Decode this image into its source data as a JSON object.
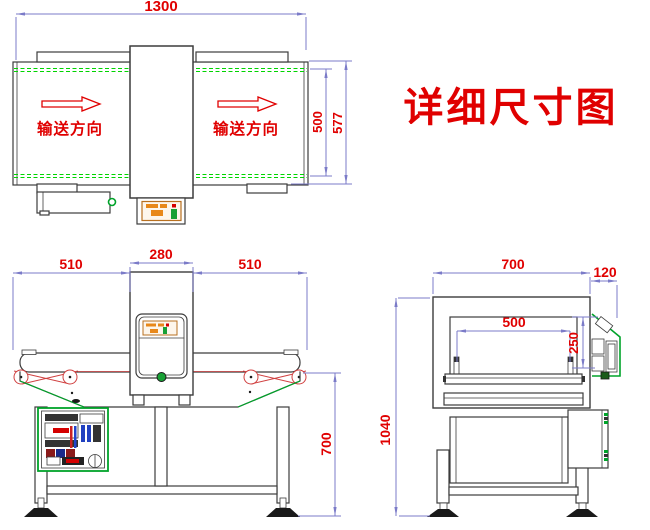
{
  "title": "详细尺寸图",
  "colors": {
    "dimension_line": "#7b7bc8",
    "dimension_text": "#e00000",
    "drawing_line": "#3c3c3c",
    "machine_green": "#00a32a",
    "belt_guide_green": "#00d400",
    "display_orange": "#e8881a"
  },
  "top_view": {
    "flow_label_left": "输送方向",
    "flow_label_right": "输送方向",
    "dim_overall_length": "1300",
    "dim_belt_width": "500",
    "dim_overall_width": "577"
  },
  "front_view": {
    "dim_infeed": "510",
    "dim_detector": "280",
    "dim_outfeed": "510",
    "dim_belt_height": "700"
  },
  "side_view": {
    "dim_body_width": "700",
    "dim_panel_depth": "120",
    "dim_aperture_width": "500",
    "dim_aperture_height": "250",
    "dim_total_height": "1040"
  }
}
